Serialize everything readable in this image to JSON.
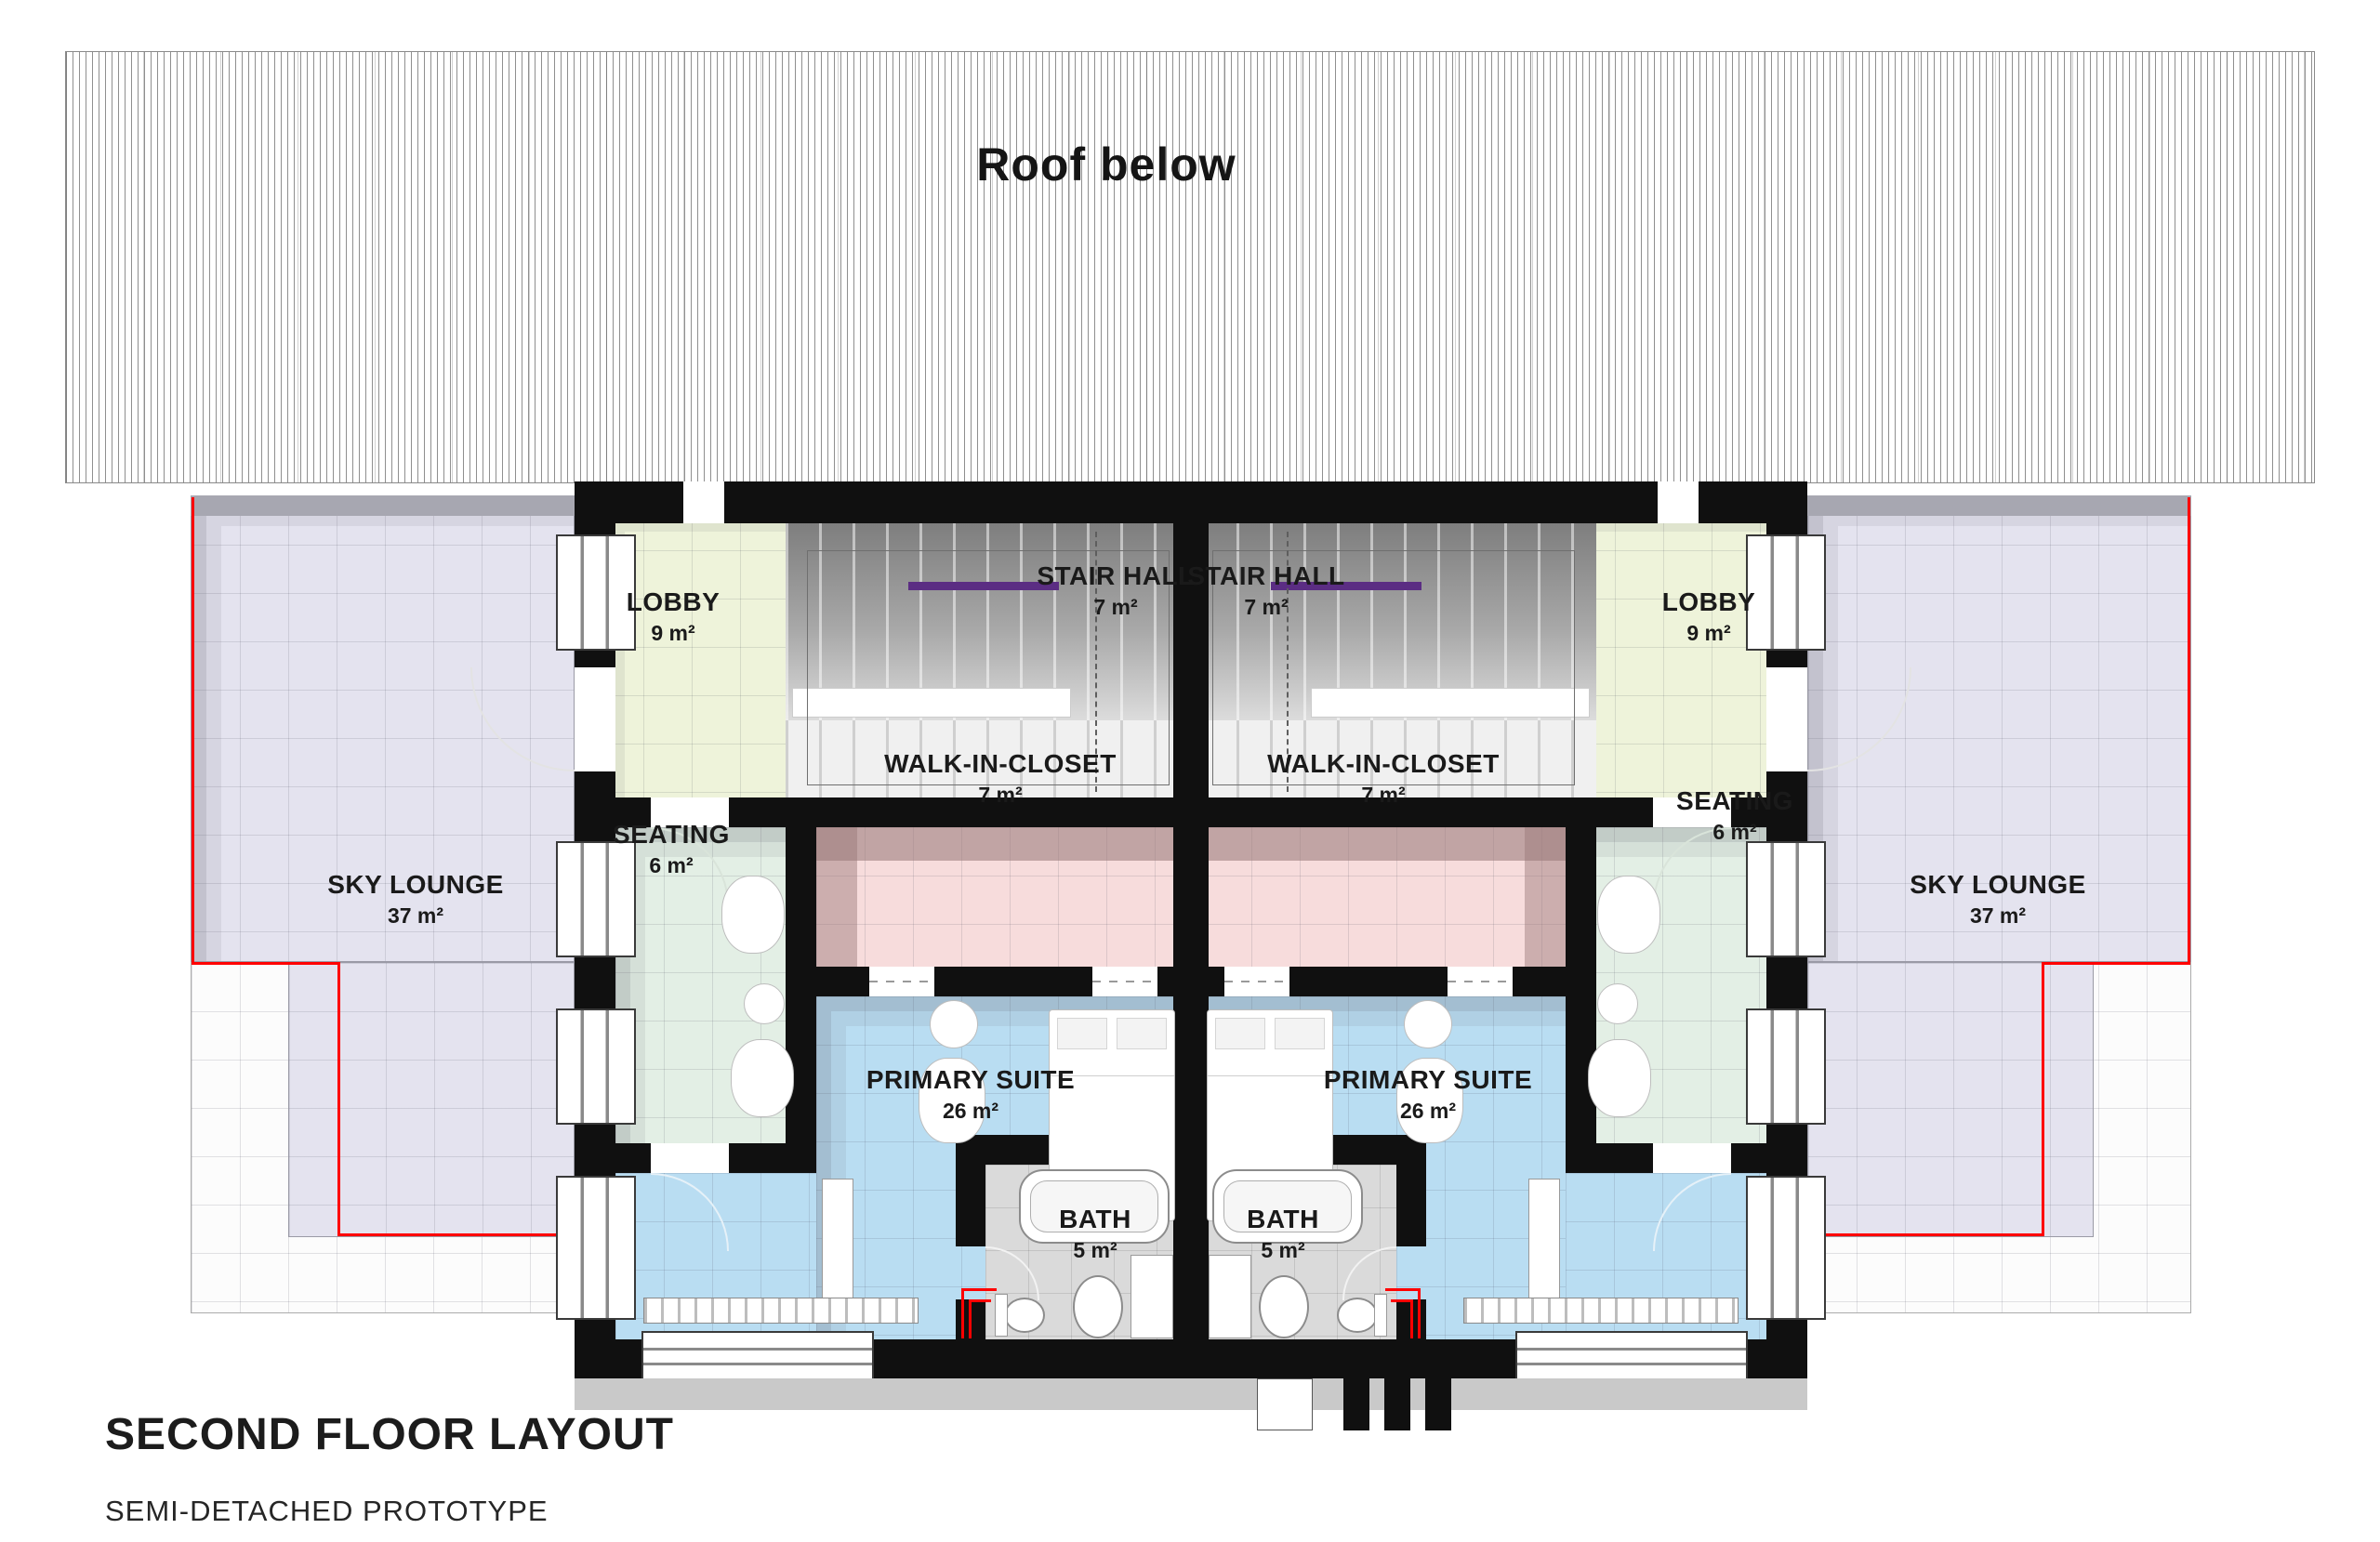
{
  "roof": {
    "label": "Roof below"
  },
  "rooms": {
    "lobby_left": {
      "name": "LOBBY",
      "area": "9 m²"
    },
    "lobby_right": {
      "name": "LOBBY",
      "area": "9 m²"
    },
    "stair_left": {
      "name": "STAIR HALL",
      "area": "7 m²"
    },
    "stair_right": {
      "name": "STAIR HALL",
      "area": "7 m²"
    },
    "wic_left": {
      "name": "WALK-IN-CLOSET",
      "area": "7 m²"
    },
    "wic_right": {
      "name": "WALK-IN-CLOSET",
      "area": "7 m²"
    },
    "seating_left": {
      "name": "SEATING",
      "area": "6 m²"
    },
    "seating_right": {
      "name": "SEATING",
      "area": "6 m²"
    },
    "sky_left": {
      "name": "SKY LOUNGE",
      "area": "37 m²"
    },
    "sky_right": {
      "name": "SKY LOUNGE",
      "area": "37 m²"
    },
    "suite_left": {
      "name": "PRIMARY SUITE",
      "area": "26 m²"
    },
    "suite_right": {
      "name": "PRIMARY SUITE",
      "area": "26 m²"
    },
    "bath_left": {
      "name": "BATH",
      "area": "5 m²"
    },
    "bath_right": {
      "name": "BATH",
      "area": "5 m²"
    }
  },
  "title_block": {
    "title": "SECOND FLOOR LAYOUT",
    "subtitle": "SEMI-DETACHED PROTOTYPE"
  },
  "colors": {
    "wall": "#101010",
    "sky_lounge": "#e4e3ef",
    "lobby": "#eef3da",
    "walk_in_closet": "#f7dcdc",
    "closet_shadow": "#b7a0a0",
    "seating": "#e3efe5",
    "primary_suite": "#b9ddf2",
    "bath_floor": "#dadada",
    "stair_rail_purple": "#5b2d83",
    "boundary_red": "#ff0000"
  }
}
